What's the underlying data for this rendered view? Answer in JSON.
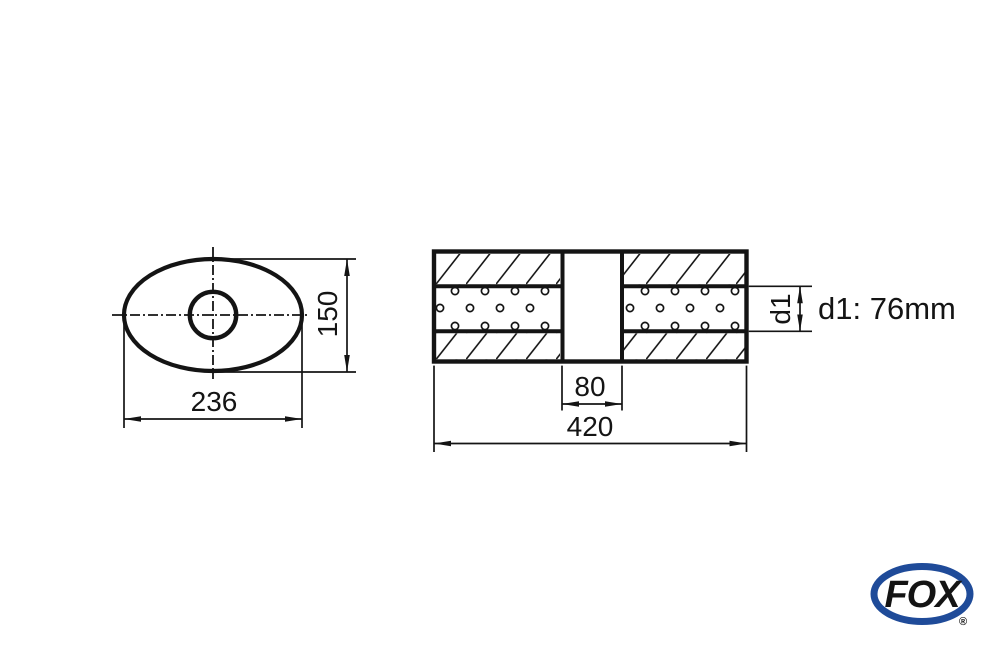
{
  "drawing": {
    "left_view": {
      "width_dim": "236",
      "height_dim": "150"
    },
    "side_view": {
      "center_gap_dim": "80",
      "total_length_dim": "420",
      "d1_axis_label": "d1",
      "d1_value_label": "d1: 76mm"
    },
    "logo": {
      "text": "FOX",
      "registered": "®",
      "color": "#1f4b99"
    },
    "line_color": "#141414"
  }
}
